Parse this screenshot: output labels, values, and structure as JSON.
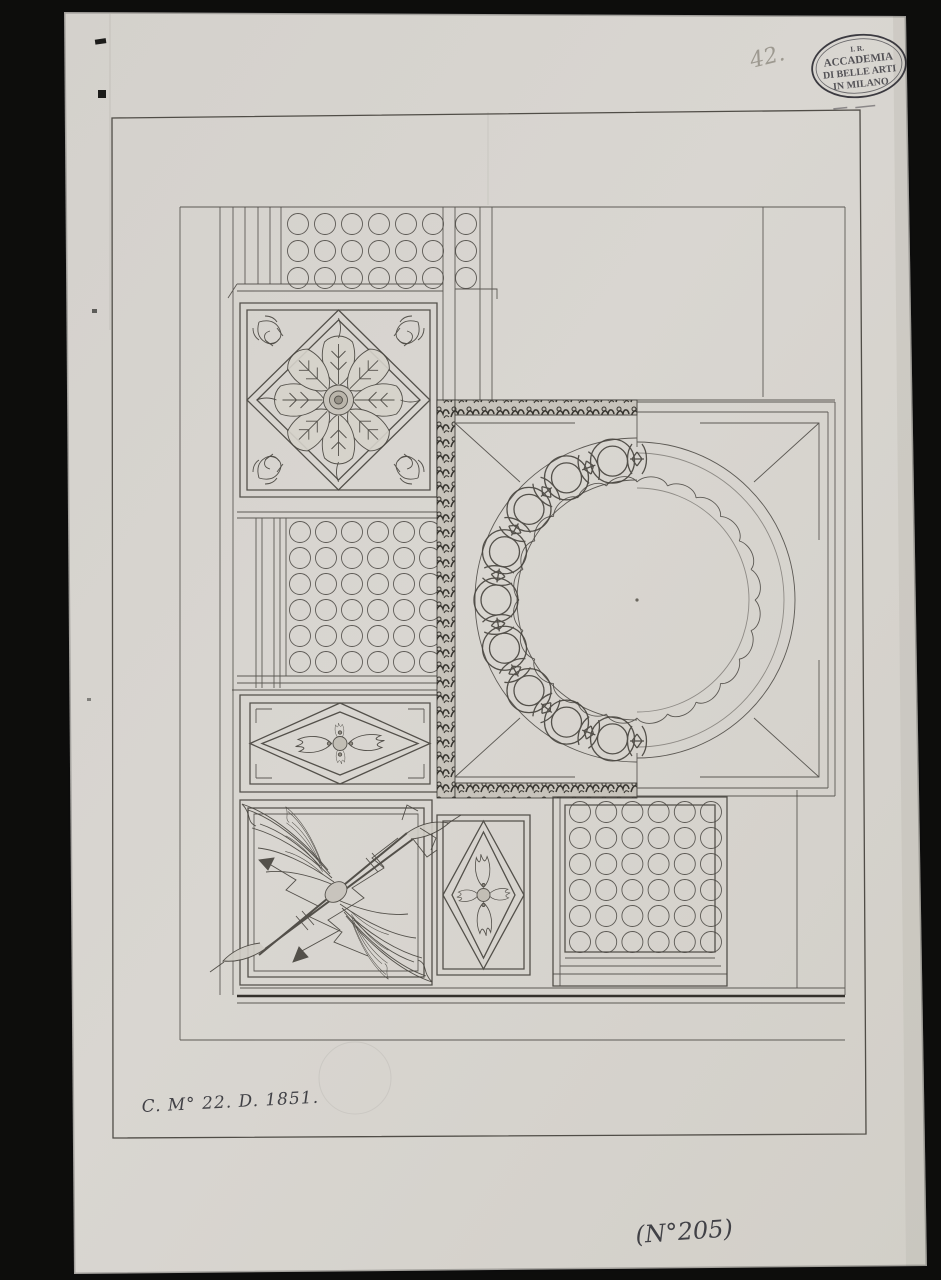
{
  "annotations": {
    "pencil_number": "42.",
    "stamp": {
      "line1": "I. R.",
      "line2": "ACCADEMIA",
      "line3": "DI BELLE ARTI",
      "line4": "IN MILANO"
    },
    "inscription": "C. M° 22. D. 1851.",
    "catalog_number": "(N°205)"
  },
  "colors": {
    "photo_background": "#0d0d0c",
    "paper": "#d7d4cf",
    "ink": "#4c4944",
    "heavy_ink": "#34312c",
    "stamp_ink": "#3b3a40",
    "pencil": "#8f8b81"
  }
}
